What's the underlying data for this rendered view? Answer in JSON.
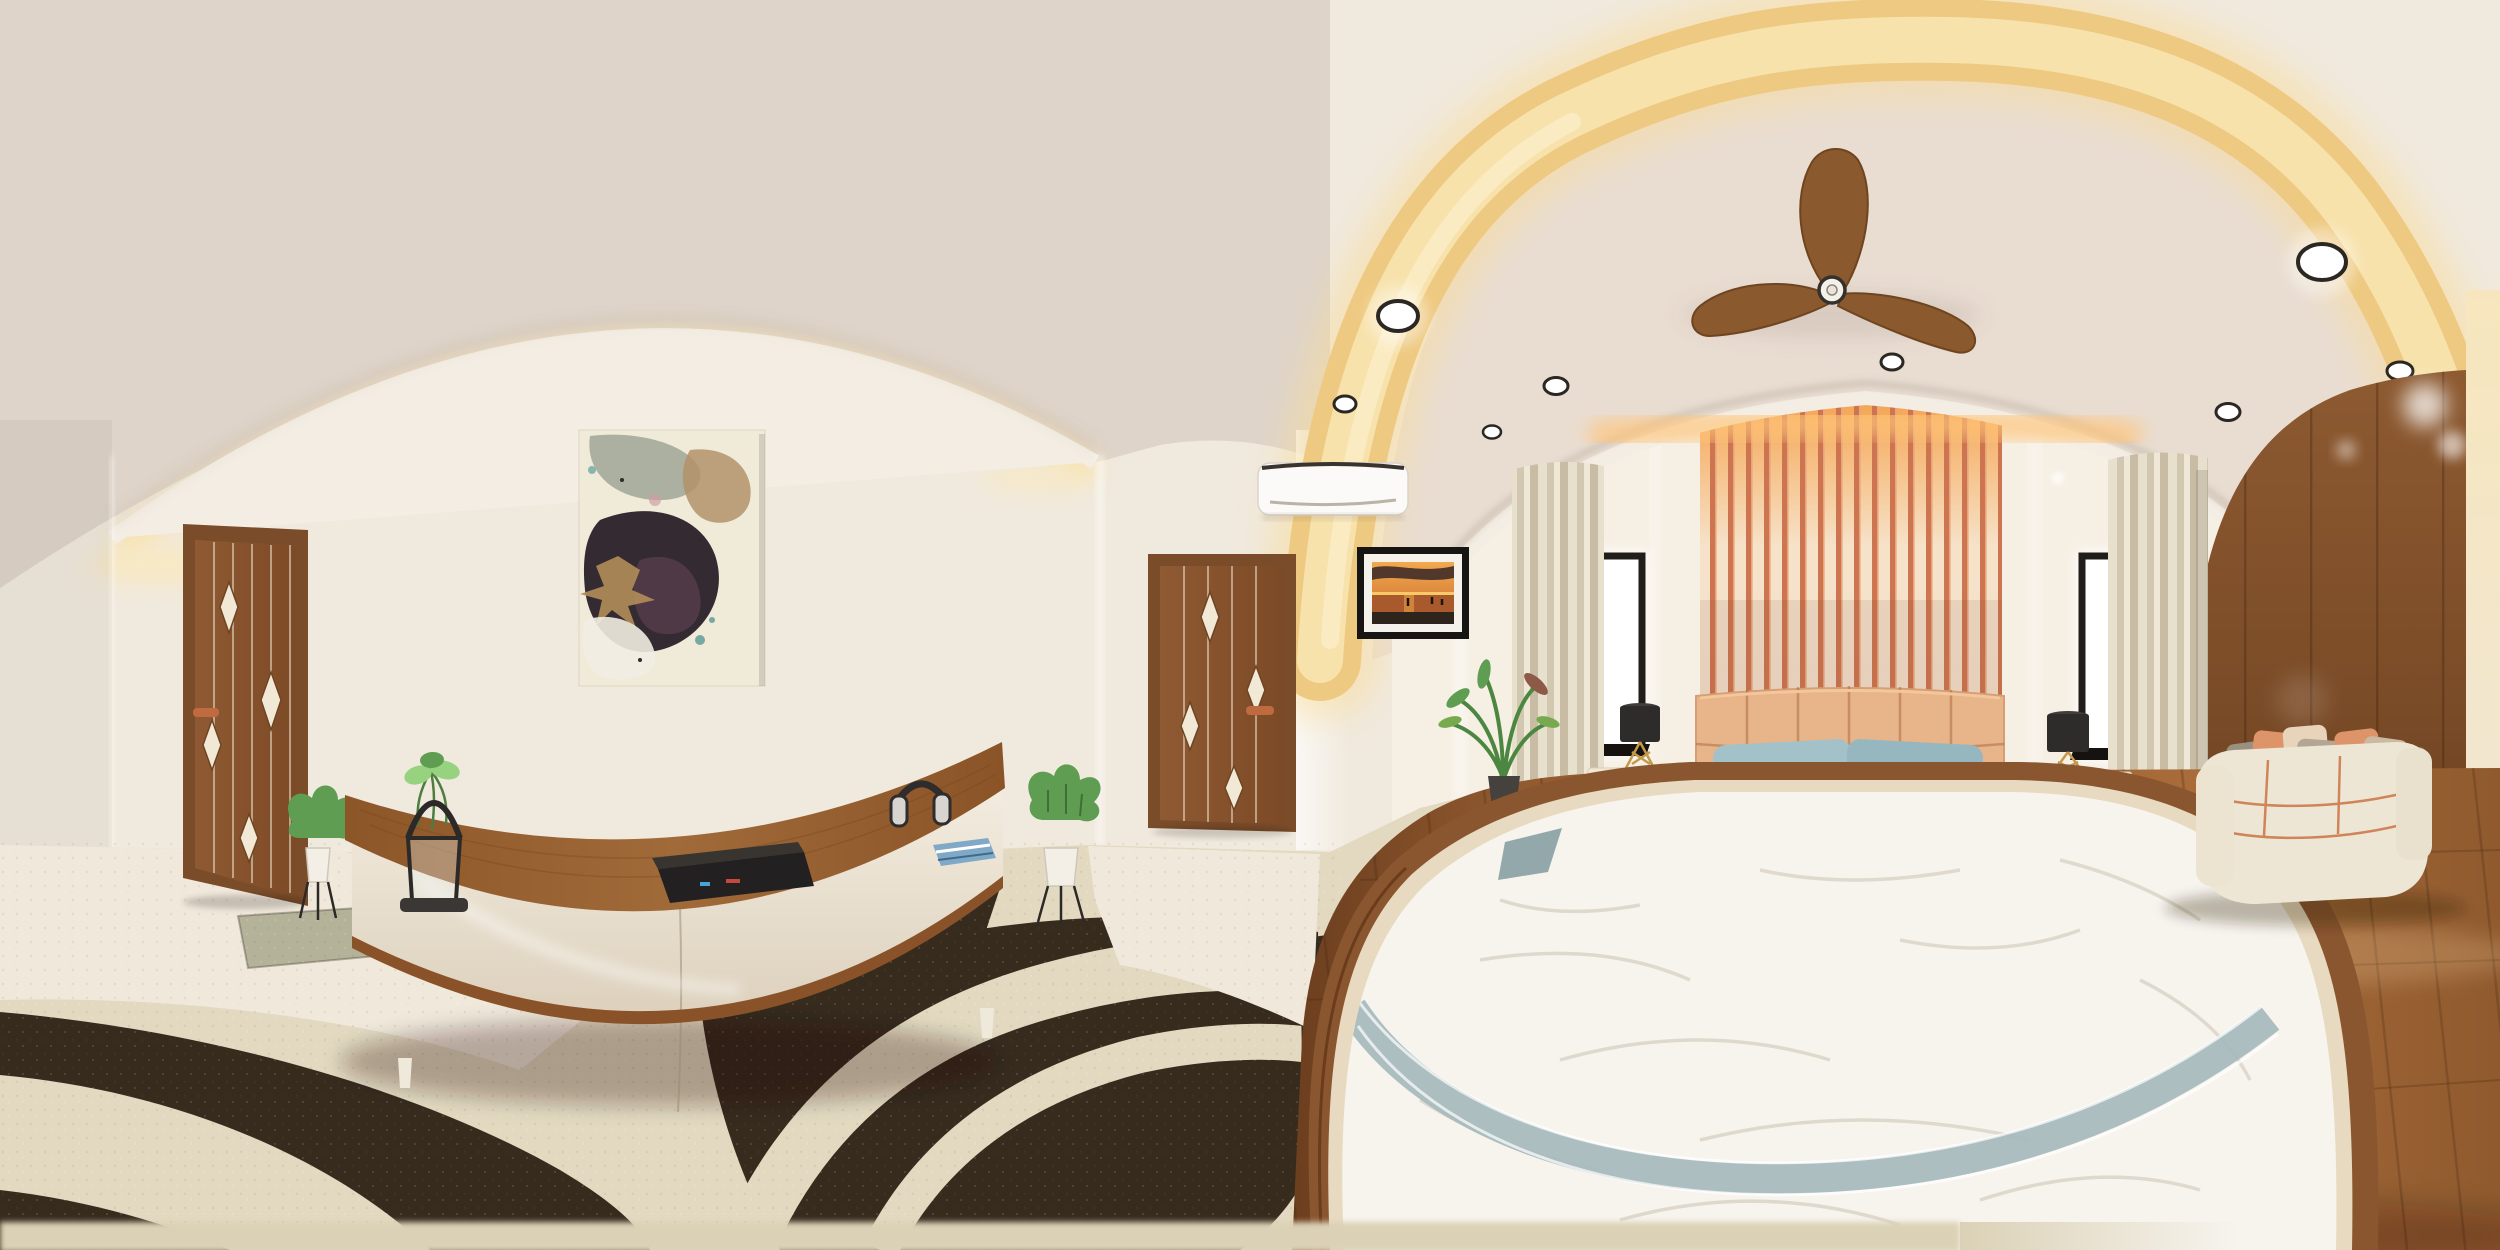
{
  "scene": {
    "type": "equirectangular-360-panorama",
    "description": "3D rendered modern bedroom interior viewed as a 360-degree panorama. Left half: cream-walled lounge side with a slatted wooden door, abstract wall art, a curved walnut-and-cream TV console (media box, headphones, lantern, plants) on a cream carpet with bold dark-brown curved rug bands. Right half: bedroom with warm LED cove lighting sweeping across the ceiling, wooden 3-blade ceiling fan, recessed spotlights, orange slat accent wall over a peach upholstered headboard, white bed with blue and patterned pillows, nightstands with black lamps, windows with beige curtains, cream sofa with cushions against a walnut panel wall, and wooden flooring.",
    "objects": {
      "left_room": [
        "wooden-door",
        "door-plant-stand",
        "abstract-painting",
        "curved-tv-console",
        "decor-lantern",
        "media-player",
        "headphones",
        "blue-book",
        "console-plant-stand",
        "arched-cove-light"
      ],
      "center": [
        "wooden-door",
        "air-conditioner",
        "framed-sunset-photo",
        "potted-plant"
      ],
      "bedroom": [
        "ceiling-fan",
        "cove-light-band",
        "recessed-spotlights",
        "slat-accent-wall",
        "upholstered-headboard",
        "double-bed",
        "white-duvet",
        "grey-runner",
        "blue-pillows",
        "patterned-pillows",
        "nightstand-left",
        "nightstand-right",
        "table-lamp-left",
        "table-lamp-right",
        "window-left",
        "window-right",
        "curtains",
        "sofa",
        "scatter-cushions",
        "wood-panel-wall",
        "wood-floor"
      ],
      "floor": [
        "cream-carpet",
        "dark-curved-rug-bands",
        "marble-tile",
        "sage-door-mat"
      ]
    },
    "counts": {
      "spotlights": 9,
      "fan_blades": 3,
      "headboard_panels": 6,
      "sofa_seats": 3
    }
  },
  "palette": {
    "wall": "#f0e9dd",
    "wall_bright": "#f6efe4",
    "ceiling": "#ded4c9",
    "ceiling_bed": "#e9ddd2",
    "cove": "#eec981",
    "cove_glow": "#ffe9b8",
    "arch_band": "#f3ede3",
    "door_wood": "#8a5732",
    "door_frame": "#7a4c29",
    "diamond": "#f1e9d6",
    "handle_copper": "#c06a3f",
    "ac_white": "#fbfaf8",
    "floor_carpet": "#e2d9c0",
    "floor_tile": "#f0e8da",
    "rug_dark": "#372b1e",
    "rug_sage": "#b5b29a",
    "floor_wood": "#9c6233",
    "panel_wood": "#7e4e2a",
    "slat_orange": "#cd7550",
    "slat_glow": "#f6c48e",
    "headboard": "#e8b489",
    "pillow_blue": "#a2c1c9",
    "pillow_taupe": "#d5c9b8",
    "pillow_dark": "#26211d",
    "sheet": "#f2e9d4",
    "duvet": "#f7f4ee",
    "band_grey": "#a8bbbd",
    "bed_wood": "#8a5630",
    "nightstand": "#f1e9d8",
    "lamp_shade": "#2e2b2b",
    "lamp_brass": "#c39a4b",
    "curtain": "#d8cfba",
    "window_frame": "#211d1a",
    "sofa": "#eee6d5",
    "piping": "#cc7a4c",
    "pillow_orange": "#dd9468",
    "pillow_grey": "#99907f",
    "leaf": "#5f9e52",
    "leaf_light": "#97d27f",
    "pot_white": "#f3efe7",
    "pot_dark": "#45413d",
    "fan_wood": "#8a5a2e",
    "console_wood": "#996334",
    "console_body": "#efe7da"
  }
}
